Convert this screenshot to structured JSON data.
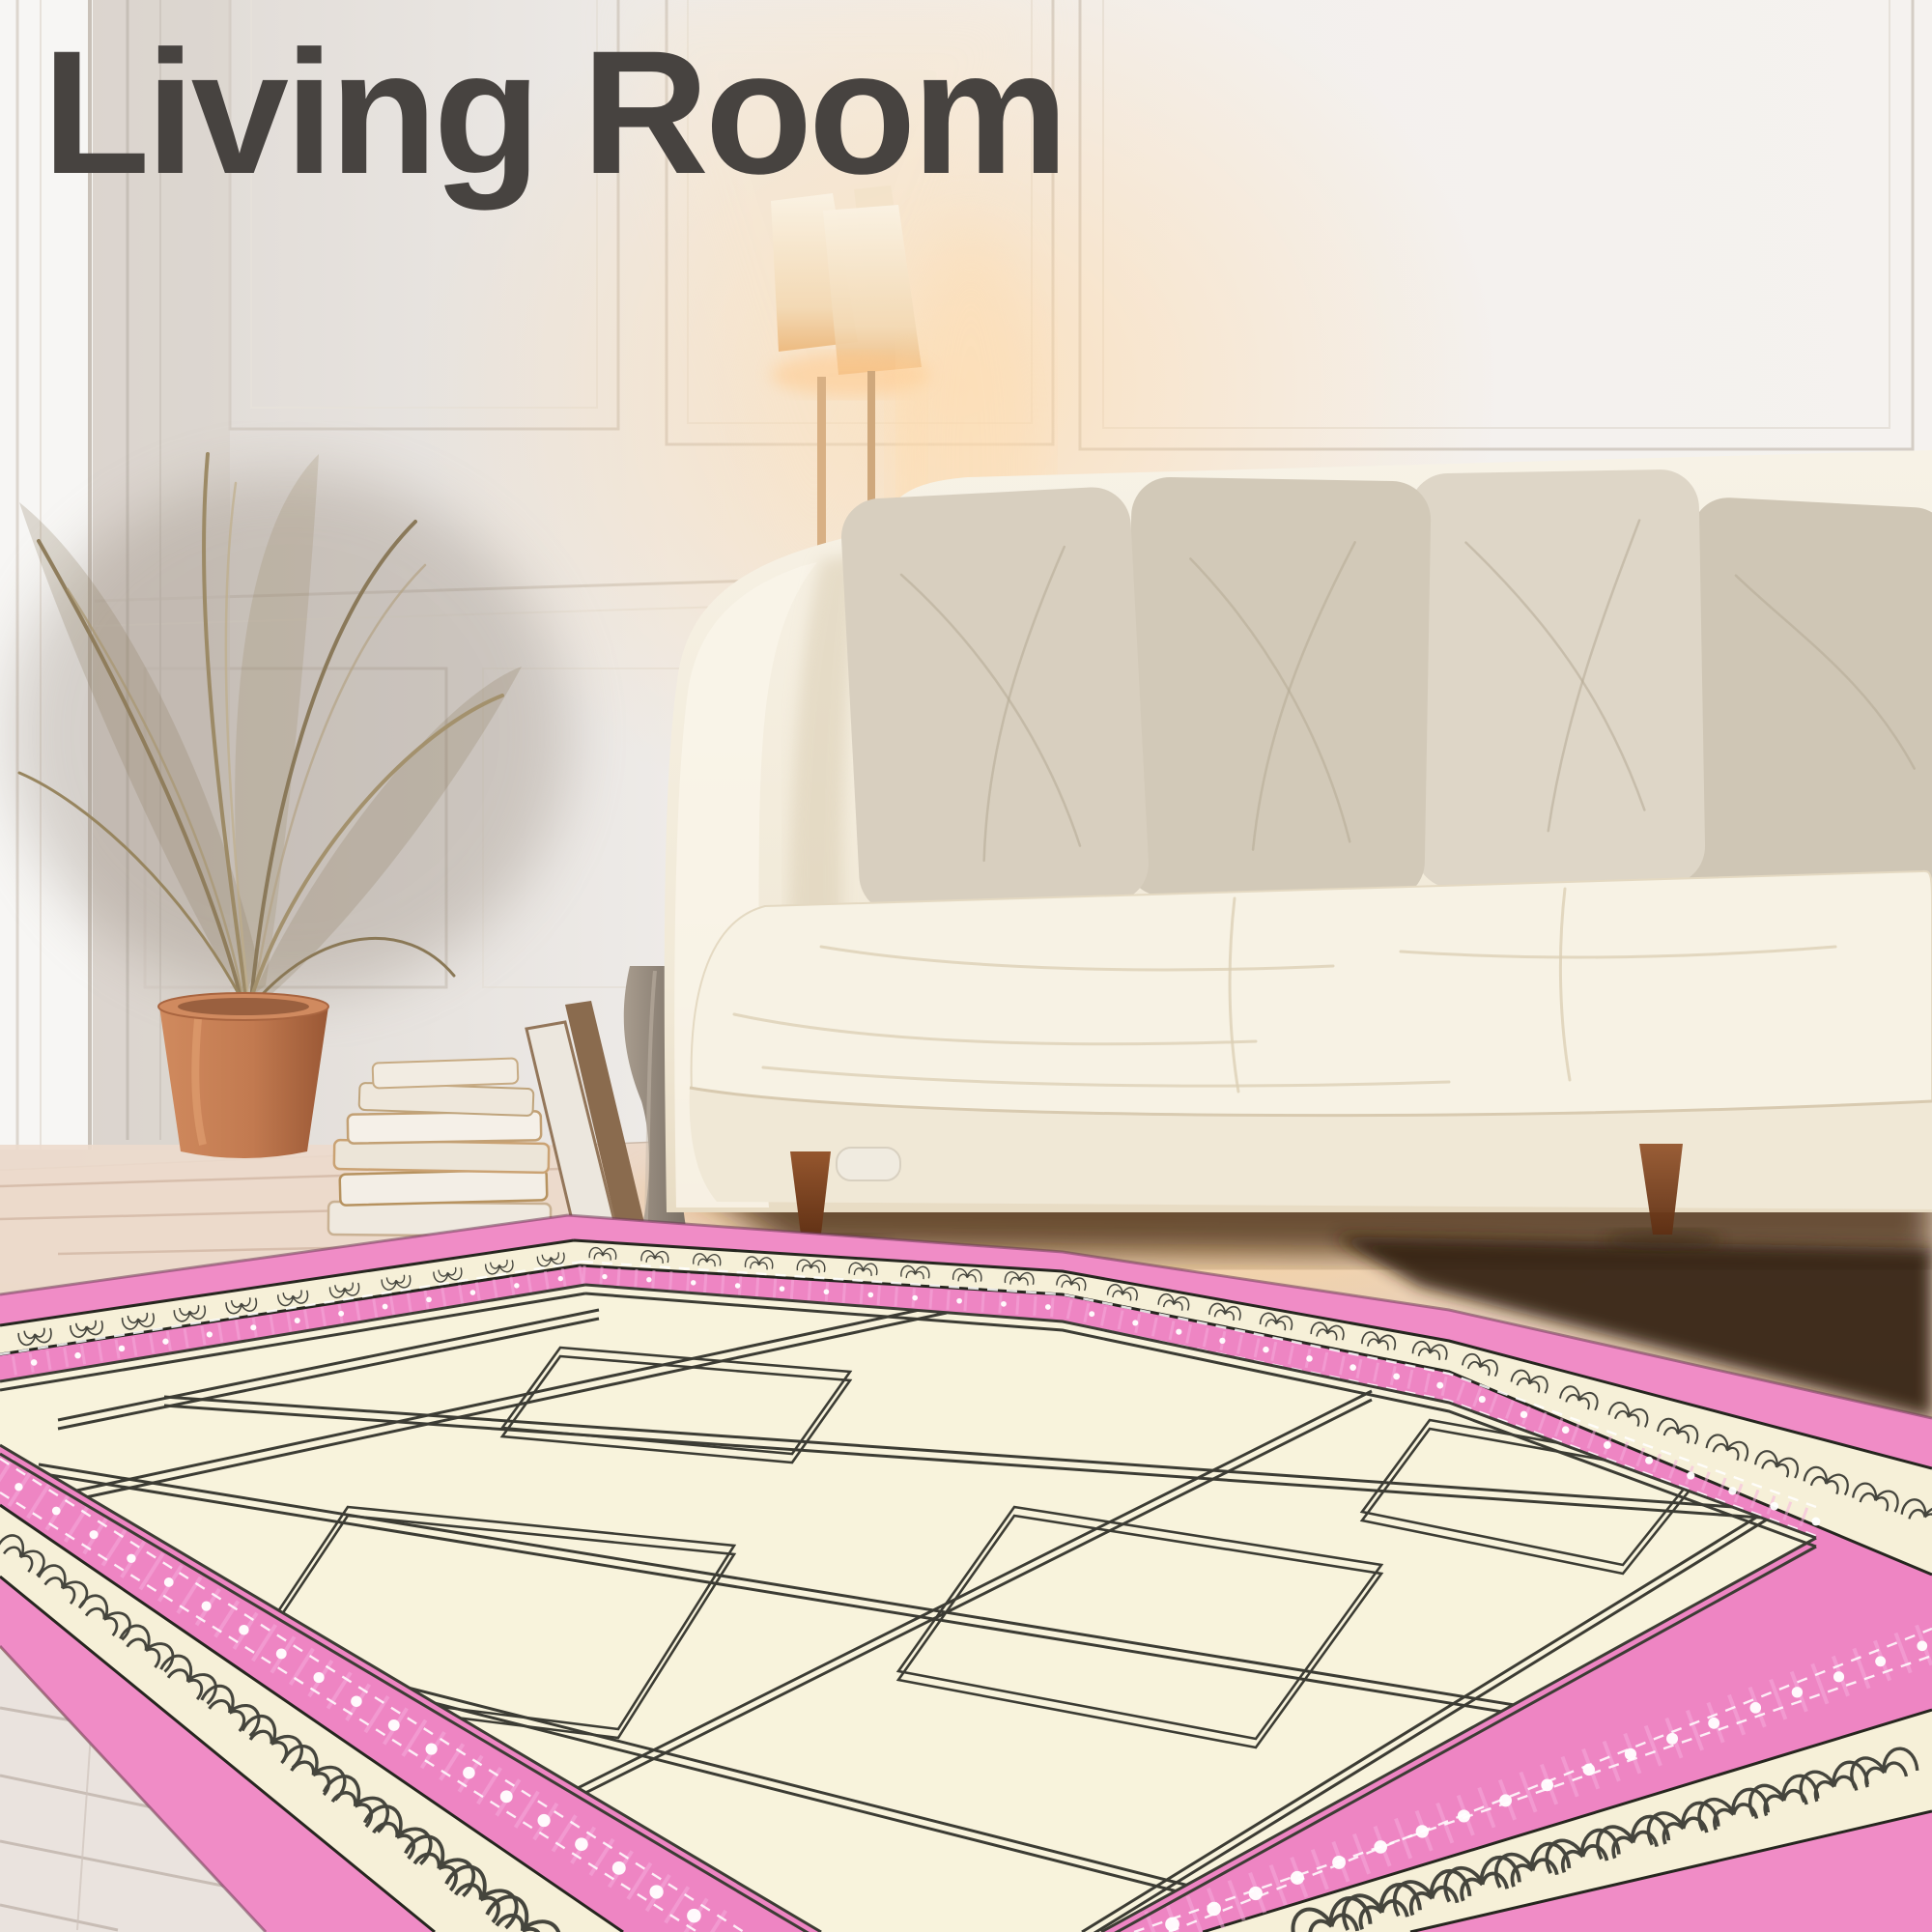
{
  "header": {
    "title": "Living Room",
    "title_color": "#474340"
  },
  "scene": {
    "objects": [
      "area rug",
      "sofa",
      "throw pillows",
      "seat cushion",
      "floor lamp",
      "dried palm plant",
      "terracotta planter",
      "stacked books",
      "leaning frames",
      "vase",
      "paneled wall",
      "wood floor",
      "whitewashed planks"
    ],
    "colors": {
      "rug_border_pink": "#f08cc6",
      "rug_ornate_pink": "#ee85c3",
      "rug_scallop_cream": "#f6f0d8",
      "rug_field_cream": "#f8f3dc",
      "rug_pattern_line": "#3c3c34",
      "sofa_cream": "#f4eedf",
      "pillow_beige": "#d4cbbb",
      "wood_floor": "#ddb792",
      "whitewashed_planks": "#eae3de",
      "terracotta_pot": "#c07a50",
      "wall_white": "#efecea",
      "lamp_glow": "#f0c28b",
      "title_gray": "#474340"
    }
  }
}
